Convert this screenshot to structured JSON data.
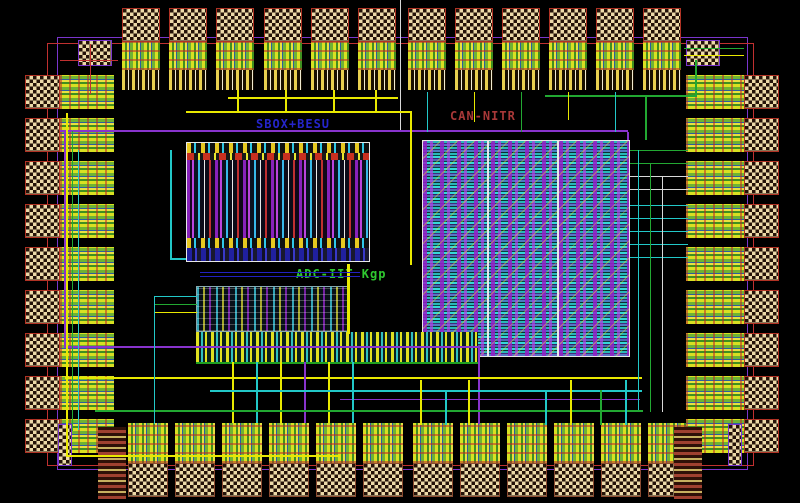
{
  "view": {
    "type": "ic-layout-die-view",
    "background": "#000000"
  },
  "blocks": [
    {
      "id": "sbox",
      "label": "SBOX+BESU",
      "label_color": "#2525cc"
    },
    {
      "id": "can",
      "label": "CAN-NITR",
      "label_color": "#a83838"
    },
    {
      "id": "adc",
      "label": "ADC-IIT Kgp",
      "label_color": "#2fc82f"
    }
  ],
  "labels": {
    "sbox": {
      "text": "SBOX+BESU"
    },
    "can": {
      "text": "CAN-NITR"
    },
    "adc": {
      "text": "ADC-IIT Kgp"
    }
  },
  "pads": {
    "top": 12,
    "bottom": 12,
    "left": 9,
    "right": 9
  },
  "palette": {
    "bond_checker": "#ecd9a8",
    "pad_border_red": "#b03224",
    "pad_border_brown": "#8a4a30",
    "seal_ring_purple": "#7a35cc",
    "esd_ring_red": "#c03030",
    "io_cell_green": "#3f8f1f",
    "io_cell_yellow": "#e8e040",
    "wire_yellow": "#e8e800",
    "wire_cyan": "#22c8c8",
    "wire_green": "#22a832",
    "wire_purple": "#8833cc",
    "wire_white": "#d8d8d8",
    "wire_blue": "#2222c0",
    "can_fill_cyan": "#35d8d8",
    "cell_purple": "#9922cc"
  }
}
